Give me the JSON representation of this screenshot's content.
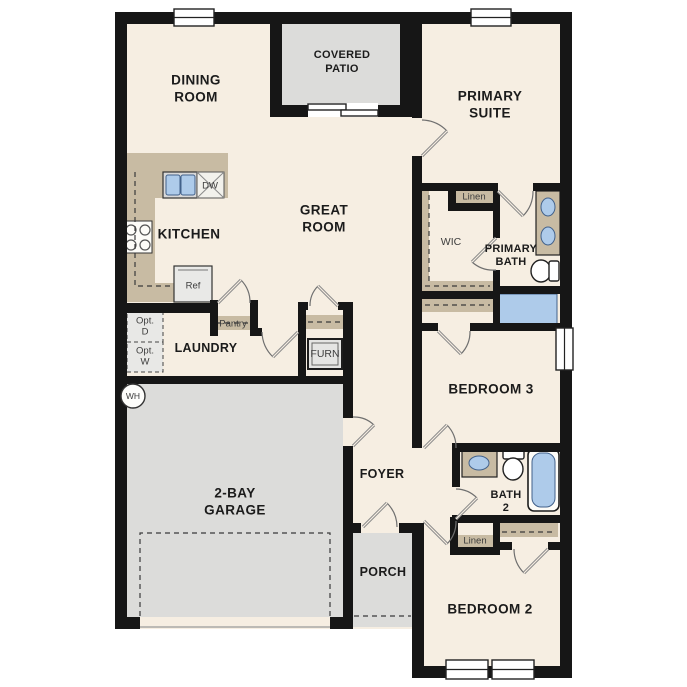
{
  "title": "Single-story floor plan",
  "colors": {
    "floor": "#f6eee2",
    "outdoor": "#dcdcda",
    "counter": "#c8bba3",
    "wall": "#161616",
    "fixture": "#aecbea",
    "fixture_stroke": "#42618a",
    "appliance": "#e8e8e6",
    "label": "#1b1b1b",
    "small_label": "#3d3d3d",
    "door": "#8a8a8a",
    "dash": "#3a3a3a"
  },
  "rooms": {
    "dining": {
      "line1": "DINING",
      "line2": "ROOM"
    },
    "covered_patio": {
      "line1": "COVERED",
      "line2": "PATIO"
    },
    "primary_suite": {
      "line1": "PRIMARY",
      "line2": "SUITE"
    },
    "great_room": {
      "line1": "GREAT",
      "line2": "ROOM"
    },
    "kitchen": {
      "label": "KITCHEN"
    },
    "wic": {
      "label": "WIC"
    },
    "primary_bath": {
      "line1": "PRIMARY",
      "line2": "BATH"
    },
    "laundry": {
      "label": "LAUNDRY"
    },
    "bedroom3": {
      "label": "BEDROOM 3"
    },
    "garage": {
      "line1": "2-BAY",
      "line2": "GARAGE"
    },
    "foyer": {
      "label": "FOYER"
    },
    "porch": {
      "label": "PORCH"
    },
    "bath2": {
      "line1": "BATH",
      "line2": "2"
    },
    "bedroom2": {
      "label": "BEDROOM 2"
    }
  },
  "features": {
    "linen_primary": "Linen",
    "linen_hall": "Linen",
    "pantry": "Pantry",
    "furnace": "FURN",
    "refrigerator": "Ref",
    "dishwasher": "DW",
    "water_heater": "WH",
    "opt_dryer_line1": "Opt.",
    "opt_dryer_line2": "D",
    "opt_washer_line1": "Opt.",
    "opt_washer_line2": "W"
  }
}
